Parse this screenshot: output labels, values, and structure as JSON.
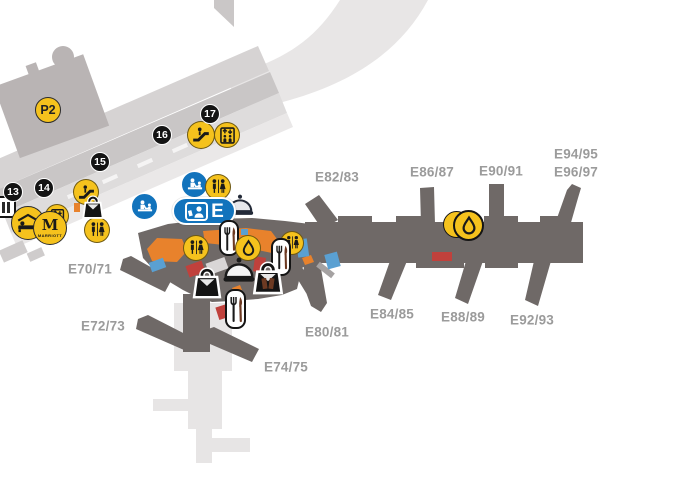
{
  "parking": {
    "label": "P2"
  },
  "gate_zone": {
    "label": "E"
  },
  "hotel": {
    "logo_letter": "M",
    "brand": "MARRIOTT"
  },
  "markers": [
    {
      "number": "13"
    },
    {
      "number": "14"
    },
    {
      "number": "15"
    },
    {
      "number": "16"
    },
    {
      "number": "17"
    }
  ],
  "gates": [
    {
      "label": "E70/71"
    },
    {
      "label": "E72/73"
    },
    {
      "label": "E74/75"
    },
    {
      "label": "E80/81"
    },
    {
      "label": "E82/83"
    },
    {
      "label": "E84/85"
    },
    {
      "label": "E86/87"
    },
    {
      "label": "E88/89"
    },
    {
      "label": "E90/91"
    },
    {
      "label": "E92/93"
    },
    {
      "label": "E94/95"
    },
    {
      "label": "E96/97"
    }
  ],
  "amenity_icons": [
    {
      "icon": "parking-icon",
      "meaning": "P2 parking garage"
    },
    {
      "icon": "escalator-icon",
      "meaning": "Escalator"
    },
    {
      "icon": "elevator-icon",
      "meaning": "Elevator"
    },
    {
      "icon": "restroom-icon",
      "meaning": "Restrooms"
    },
    {
      "icon": "hotel-bed-icon",
      "meaning": "Hotel"
    },
    {
      "icon": "marriott-icon",
      "meaning": "Marriott hotel"
    },
    {
      "icon": "shopping-bag-icon",
      "meaning": "Shopping"
    },
    {
      "icon": "dining-cloche-icon",
      "meaning": "Food service"
    },
    {
      "icon": "fork-knife-icon",
      "meaning": "Restaurant"
    },
    {
      "icon": "water-drop-icon",
      "meaning": "Water refill / fuel"
    },
    {
      "icon": "attendant-desk-icon",
      "meaning": "Service desk"
    },
    {
      "icon": "baby-care-icon",
      "meaning": "Baby care"
    },
    {
      "icon": "passport-control-icon",
      "meaning": "Passport control gates E"
    },
    {
      "icon": "ground-transport-icon",
      "meaning": "Ground transport"
    }
  ],
  "colors": {
    "amenity_yellow": "#F5C21D",
    "marker_black": "#141414",
    "service_blue": "#1273BC",
    "concourse_gray": "#6F6967",
    "building_gray": "#B9B4B4",
    "road_gray": "#C9C6C6",
    "label_gray": "#9B9B9B",
    "shop_orange": "#E8822C",
    "unit_red": "#C0413C",
    "unit_blue": "#5AA0D2"
  }
}
